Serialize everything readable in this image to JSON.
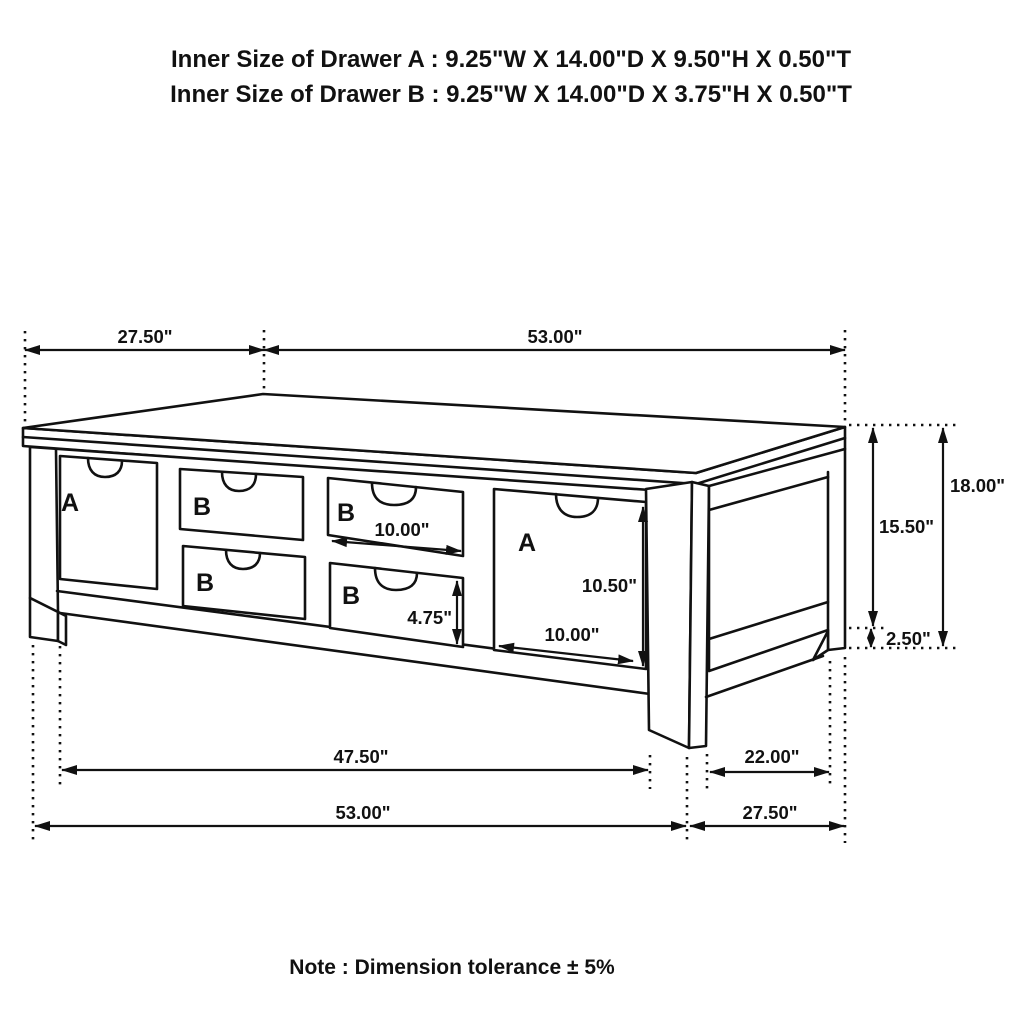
{
  "title_block": {
    "line1": "Inner Size of Drawer A : 9.25\"W X 14.00\"D X 9.50\"H X 0.50\"T",
    "line2": "Inner Size of Drawer B : 9.25\"W X 14.00\"D X 3.75\"H X 0.50\"T"
  },
  "note": "Note : Dimension tolerance ± 5%",
  "drawer_labels": {
    "left_a": "A",
    "col1_top_b": "B",
    "col1_bottom_b": "B",
    "col2_top_b": "B",
    "col2_bottom_b": "B",
    "right_a": "A"
  },
  "dimensions": {
    "top_depth": "27.50\"",
    "top_width": "53.00\"",
    "drawer_b_width": "10.00\"",
    "drawer_b_opening_height": "4.75\"",
    "drawer_a_opening_height": "10.50\"",
    "drawer_a_width": "10.00\"",
    "apron_height": "15.50\"",
    "leg_foot_height": "2.50\"",
    "total_height": "18.00\"",
    "front_leg_span": "47.50\"",
    "side_leg_span": "22.00\"",
    "bottom_width": "53.00\"",
    "bottom_depth": "27.50\""
  },
  "colors": {
    "label_red": "#cc1318",
    "line": "#111111",
    "background": "#ffffff"
  }
}
